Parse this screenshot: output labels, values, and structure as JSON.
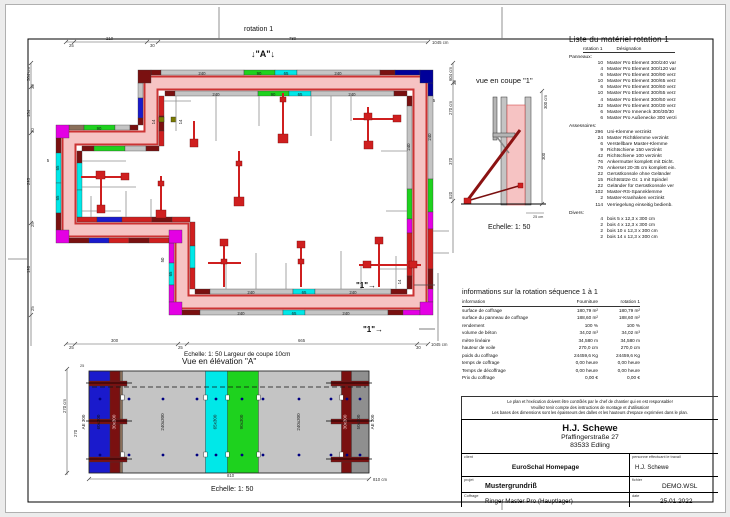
{
  "frame": {
    "rotation_label": "rotation 1"
  },
  "colors": {
    "wall_core": "#f6c3c3",
    "edge_red": "#cc3333",
    "element_gray": "#c4c4c4",
    "element_green": "#1ed21e",
    "element_cyan": "#00e8e8",
    "element_blue": "#1a1acc",
    "element_navy": "#000099",
    "element_magenta": "#e400e4",
    "element_darkred": "#7a1010",
    "element_red": "#cf1f1f",
    "prop_red": "#cf1f1f"
  },
  "plan": {
    "marker_a": "↓\"A\"↓",
    "marker_1": "\"1\"→",
    "lab_240": "240",
    "lab_90": "90",
    "lab_65": "65",
    "lab_14": "14",
    "lab_5": "5",
    "lab_50": "50",
    "dim_top": {
      "s1": "25",
      "s2": "210",
      "s3": "30",
      "s4": "780",
      "total": "1045 cm"
    },
    "dim_left": {
      "total": "584 cm",
      "s1": "30",
      "s2": "134",
      "s3": "30",
      "s4": "295",
      "s5": "25",
      "s6": "198",
      "s7": "25"
    },
    "dim_bottom": {
      "s1": "25",
      "s2": "300",
      "s3": "25",
      "s4": "665",
      "s5": "30",
      "total": "1045 cm"
    },
    "dim_right": {
      "total": "604 cm",
      "s1": "30",
      "s2": "270 cm",
      "s3": "370",
      "s4": "620"
    }
  },
  "section": {
    "title": "vue en coupe \"1\"",
    "scale": "Echelle: 1: 50",
    "dim_300cm": "300 cm",
    "dim_300": "300",
    "dim_25cm": "25 cm"
  },
  "elevation": {
    "subtitle": "Echelle: 1: 50  Largeur de coupe 10cm",
    "title": "Vue en élévation \"A\"",
    "scale": "Echelle: 1: 50",
    "panels": [
      "AE 300",
      "60x300",
      "30x300",
      "240x300",
      "65x300",
      "90x300",
      "240x300",
      "30x300",
      "50x300",
      "AE 300"
    ],
    "dim_810": "810",
    "dim_810cm": "810 cm",
    "dim_270cm": "270 cm",
    "dim_270": "270",
    "dim_25": "25"
  },
  "material_list": {
    "title": "Liste du matériel  rotation 1",
    "header_qty": "rotation 1",
    "header_des": "Désignation",
    "rows": [
      {
        "qty": "",
        "label": "Panneaux:",
        "cls": "group"
      },
      {
        "qty": "10",
        "label": "Master Pro Element 300/240 var"
      },
      {
        "qty": "4",
        "label": "Master Pro Element 300/120 var"
      },
      {
        "qty": "6",
        "label": "Master Pro Element 300/90 verz"
      },
      {
        "qty": "10",
        "label": "Master Pro Element 300/65 verz"
      },
      {
        "qty": "6",
        "label": "Master Pro Element 300/60 verz"
      },
      {
        "qty": "10",
        "label": "Master Pro Element 300/55 verz"
      },
      {
        "qty": "4",
        "label": "Master Pro Element 300/50 verz"
      },
      {
        "qty": "32",
        "label": "Master Pro Element 300/30 verz"
      },
      {
        "qty": "6",
        "label": "Master Pro Inneneck 300/30/30"
      },
      {
        "qty": "6",
        "label": "Master Pro Außenecke 300 verzi"
      },
      {
        "qty": "",
        "label": "Assessoires:",
        "cls": "group"
      },
      {
        "qty": "296",
        "label": "Uni-Klemme verzinkt"
      },
      {
        "qty": "24",
        "label": "Master Richtklemme verzinkt"
      },
      {
        "qty": "6",
        "label": "Verstellbare Master-Klemme"
      },
      {
        "qty": "9",
        "label": "Richtschiene 150 verzinkt"
      },
      {
        "qty": "42",
        "label": "Richtschiene 100 verzinkt"
      },
      {
        "qty": "76",
        "label": "Ankermutter komplett mit Dicht."
      },
      {
        "qty": "76",
        "label": "Ankerset 20-35 cm komplett ein."
      },
      {
        "qty": "22",
        "label": "Gerüstkonsole ohne Geländer"
      },
      {
        "qty": "15",
        "label": "Richtstütze Gr. 1 mit Spindel"
      },
      {
        "qty": "22",
        "label": "Geländer für Gerüstkonsole ver"
      },
      {
        "qty": "102",
        "label": "Master-RS-Spannklemme"
      },
      {
        "qty": "2",
        "label": "Master-Kranhaken verzinkt"
      },
      {
        "qty": "114",
        "label": "Verriegelung einseitig bedienb."
      },
      {
        "qty": "",
        "label": "Divers:",
        "cls": "group"
      },
      {
        "qty": "4",
        "label": "bois 5 x 12,3 x 300 cm"
      },
      {
        "qty": "2",
        "label": "bois 4 x 12,3 x 300 cm"
      },
      {
        "qty": "2",
        "label": "bois 10 x 12,3 x 300 cm"
      },
      {
        "qty": "2",
        "label": "bois 14 x 12,3 x 300 cm"
      }
    ]
  },
  "info_table": {
    "title": "informations sur la rotation  séquence 1 à 1",
    "col_info": "information",
    "col_fourniture": "Fourniture",
    "col_rotation": "rotation 1",
    "rows": [
      {
        "label": "surface de coffrage",
        "f": "180,79 m²",
        "r": "180,79 m²"
      },
      {
        "label": "surface du panneau de coffrage",
        "f": "188,60 m²",
        "r": "188,60 m²"
      },
      {
        "label": "rendement",
        "f": "100 %",
        "r": "100 %"
      },
      {
        "label": "volume de béton",
        "f": "34,02 m³",
        "r": "34,02 m³"
      },
      {
        "label": "mètre linéaire",
        "f": "34,580 m",
        "r": "34,580 m"
      },
      {
        "label": "hauteur de voile",
        "f": "270,0 cm",
        "r": "270,0 cm"
      },
      {
        "label": "poids du coffrage",
        "f": "24459,6 Kg",
        "r": "24459,6 Kg"
      },
      {
        "label": "temps de coffrage",
        "f": "0,00 heure",
        "r": "0,00 heure"
      },
      {
        "label": "Temps de décoffrage",
        "f": "0,00 heure",
        "r": "0,00 heure"
      },
      {
        "label": "Prix du coffrage",
        "f": "0,00 €",
        "r": "0,00 €"
      }
    ]
  },
  "warning": {
    "line1": "Le plan et l'exécution doivent être contrôlés par le chef de chantier qui en est responsable!",
    "line2": "Veuillez tenir compte des instructions de montage et d'utilisation!",
    "line3": "Les bases des dimensions sont les épaisseurs des dalles et les hauteurs d'espace exprimées dans le plan."
  },
  "title_block": {
    "company": "H.J. Schewe",
    "address1": "Pfaffingerstraße 27",
    "address2": "83533 Edling",
    "client_label": "client",
    "client": "EuroSchal Homepage",
    "worker_label": "personne effectuant le travail",
    "worker": "H.J. Schewe",
    "project_label": "projet",
    "project": "Mustergrundriß",
    "file_label": "fichier",
    "file": "DEMO.WSL",
    "formwork_label": "Coffrage",
    "formwork": "Ringer Master Pro (Hauptlager)",
    "date_label": "date",
    "date": "25.01.2022"
  }
}
